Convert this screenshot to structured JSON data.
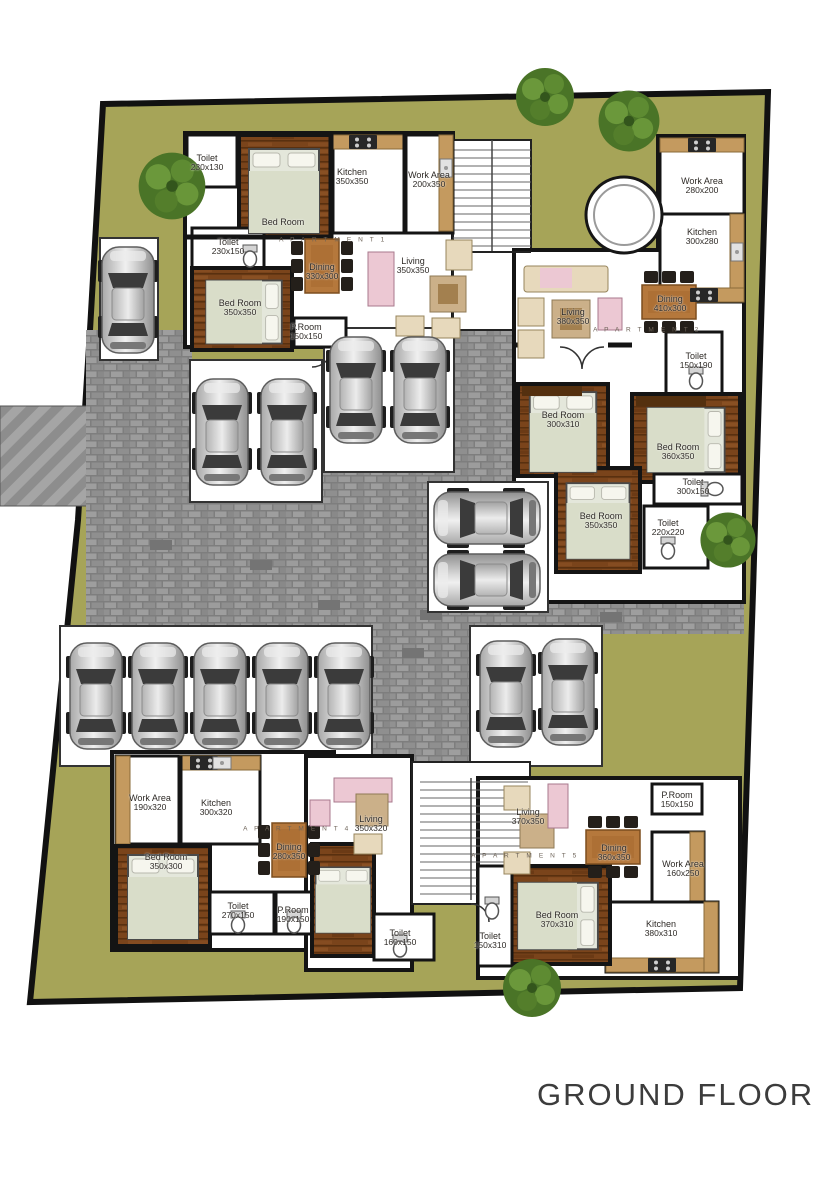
{
  "title": "GROUND FLOOR",
  "colors": {
    "grass": "#a6a458",
    "paver": "#999999",
    "wall": "#141414",
    "wood_floor": "#7a441b",
    "counter": "#c49a5f",
    "bed": "#e4e7db",
    "sofa_pink": "#ecc8d3",
    "sofa_cream": "#e7d9bc",
    "dining_table": "#b5783c",
    "tree": "#4a7427"
  },
  "apartments": [
    {
      "name": "A P A R T M E N T   1",
      "x": 333,
      "y": 240
    },
    {
      "name": "A P A R T M E N T   2",
      "x": 647,
      "y": 330
    },
    {
      "name": "A P A R T M E N T   4",
      "x": 297,
      "y": 829
    },
    {
      "name": "A P A R T M E N T   5",
      "x": 525,
      "y": 856
    }
  ],
  "rooms": [
    {
      "label": "Toilet",
      "dims": "230x130",
      "x": 207,
      "y": 163
    },
    {
      "label": "Bed Room",
      "dims": "",
      "x": 283,
      "y": 222
    },
    {
      "label": "Kitchen",
      "dims": "350x350",
      "x": 352,
      "y": 177
    },
    {
      "label": "Work Area",
      "dims": "200x350",
      "x": 429,
      "y": 180
    },
    {
      "label": "Toilet",
      "dims": "230x150",
      "x": 228,
      "y": 247
    },
    {
      "label": "Dining",
      "dims": "330x300",
      "x": 322,
      "y": 272
    },
    {
      "label": "Living",
      "dims": "350x350",
      "x": 413,
      "y": 266
    },
    {
      "label": "Bed Room",
      "dims": "350x350",
      "x": 240,
      "y": 308
    },
    {
      "label": "P.Room",
      "dims": "150x150",
      "x": 306,
      "y": 332
    },
    {
      "label": "Work Area",
      "dims": "280x200",
      "x": 702,
      "y": 186
    },
    {
      "label": "Kitchen",
      "dims": "300x280",
      "x": 702,
      "y": 237
    },
    {
      "label": "Living",
      "dims": "380x350",
      "x": 573,
      "y": 317
    },
    {
      "label": "Dining",
      "dims": "410x300",
      "x": 670,
      "y": 304
    },
    {
      "label": "Toilet",
      "dims": "150x190",
      "x": 696,
      "y": 361
    },
    {
      "label": "Bed Room",
      "dims": "300x310",
      "x": 563,
      "y": 420
    },
    {
      "label": "Bed Room",
      "dims": "360x350",
      "x": 678,
      "y": 452
    },
    {
      "label": "Toilet",
      "dims": "300x150",
      "x": 693,
      "y": 487
    },
    {
      "label": "Bed Room",
      "dims": "350x350",
      "x": 601,
      "y": 521
    },
    {
      "label": "Toilet",
      "dims": "220x220",
      "x": 668,
      "y": 528
    },
    {
      "label": "Work Area",
      "dims": "190x320",
      "x": 150,
      "y": 803
    },
    {
      "label": "Kitchen",
      "dims": "300x320",
      "x": 216,
      "y": 808
    },
    {
      "label": "Bed Room",
      "dims": "350x300",
      "x": 166,
      "y": 862
    },
    {
      "label": "Dining",
      "dims": "280x350",
      "x": 289,
      "y": 852
    },
    {
      "label": "Toilet",
      "dims": "270x150",
      "x": 238,
      "y": 911
    },
    {
      "label": "P.Room",
      "dims": "190x150",
      "x": 293,
      "y": 915
    },
    {
      "label": "Living",
      "dims": "350x320",
      "x": 371,
      "y": 824
    },
    {
      "label": "Toilet",
      "dims": "160x150",
      "x": 400,
      "y": 938
    },
    {
      "label": "Toilet",
      "dims": "150x310",
      "x": 490,
      "y": 941
    },
    {
      "label": "P.Room",
      "dims": "150x150",
      "x": 677,
      "y": 800
    },
    {
      "label": "Living",
      "dims": "370x350",
      "x": 528,
      "y": 817
    },
    {
      "label": "Dining",
      "dims": "360x350",
      "x": 614,
      "y": 853
    },
    {
      "label": "Work Area",
      "dims": "160x250",
      "x": 683,
      "y": 869
    },
    {
      "label": "Kitchen",
      "dims": "380x310",
      "x": 661,
      "y": 929
    },
    {
      "label": "Bed Room",
      "dims": "370x310",
      "x": 557,
      "y": 920
    }
  ]
}
